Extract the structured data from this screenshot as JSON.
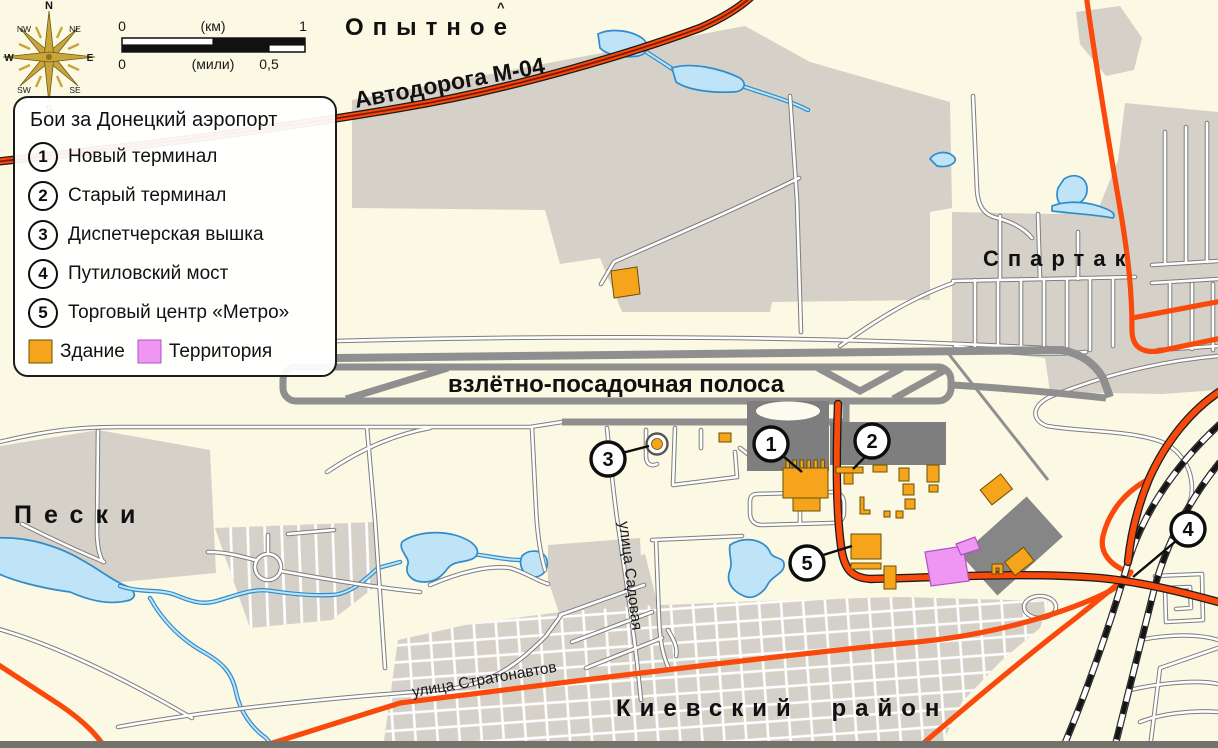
{
  "legend": {
    "title": "Бои за Донецкий аэропорт",
    "items": [
      {
        "num": "1",
        "label": "Новый терминал"
      },
      {
        "num": "2",
        "label": "Старый терминал"
      },
      {
        "num": "3",
        "label": "Диспетчерская вышка"
      },
      {
        "num": "4",
        "label": "Путиловский мост"
      },
      {
        "num": "5",
        "label": "Торговый центр «Метро»"
      }
    ],
    "building_label": "Здание",
    "territory_label": "Территория"
  },
  "compass": {
    "n": "N",
    "ne": "NE",
    "e": "E",
    "se": "SE",
    "s": "S",
    "sw": "SW",
    "w": "W",
    "nw": "NW"
  },
  "scalebar": {
    "km_start": "0",
    "km_unit": "(км)",
    "km_end": "1",
    "mi_start": "0",
    "mi_unit": "(мили)",
    "mi_half": "0,5"
  },
  "labels": {
    "opytne": "Опытное",
    "opytne_mark": "^",
    "highway_m04": "Автодорога М-04",
    "spartak": "Спартак",
    "peski": "Пески",
    "kyivskyi_district": "Киевский район",
    "runway": "взлётно-посадочная полоса",
    "sadovaya_street": "улица Садовая",
    "stratonavtov_street": "улица Стратонавтов"
  },
  "markers": [
    {
      "num": "1"
    },
    {
      "num": "2"
    },
    {
      "num": "3"
    },
    {
      "num": "4"
    },
    {
      "num": "5"
    }
  ],
  "colors": {
    "background": "#FBF8E3",
    "urban_gray": "#D5D1C8",
    "road_orange": "#F9490B",
    "building_orange": "#F6A41C",
    "territory_pink": "#EE96F2",
    "water_fill": "#BFE3F7",
    "water_stroke": "#2F8CCB",
    "runway_gray": "#8F8F8F",
    "terminal_gray": "#7E7E7E"
  }
}
